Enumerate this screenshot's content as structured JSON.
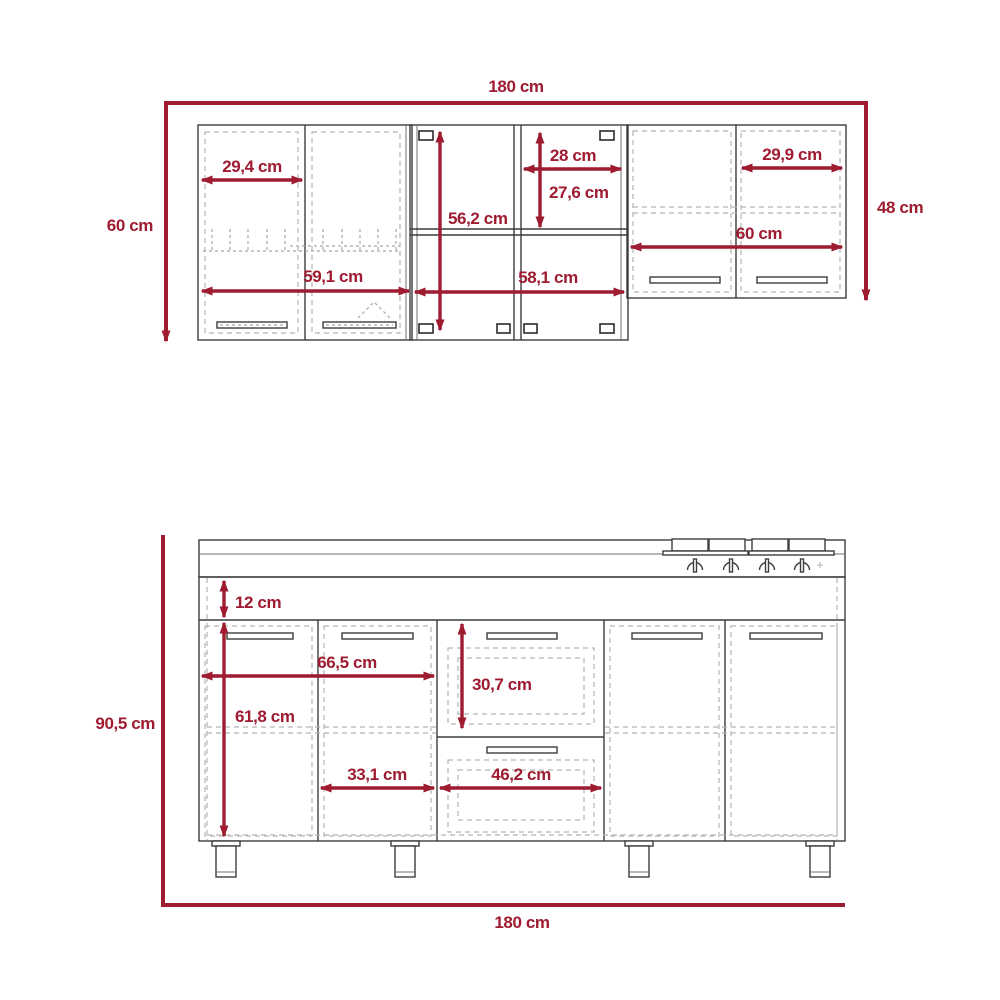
{
  "title": "kitchen-cabinet-dimension-drawing",
  "colors": {
    "accent": "#9E1B30",
    "outline": "#3d3d3d",
    "dashed": "#b3b3b3",
    "background": "#ffffff"
  },
  "upper": {
    "total_width": "180 cm",
    "left_height": "60 cm",
    "right_height": "48 cm",
    "left_door_width": "29,4 cm",
    "left_unit_width": "59,1 cm",
    "mid_inner_height": "56,2 cm",
    "mid_col_width": "28 cm",
    "mid_top_height": "27,6 cm",
    "mid_unit_width": "58,1 cm",
    "right_door_width": "29,9 cm",
    "right_unit_width": "60 cm"
  },
  "lower": {
    "height": "90,5 cm",
    "total_width": "180 cm",
    "rail_height": "12 cm",
    "left_span_width": "66,5 cm",
    "door_height": "61,8 cm",
    "drawer_height": "30,7 cm",
    "door_width": "33,1 cm",
    "drawer_width": "46,2 cm"
  }
}
